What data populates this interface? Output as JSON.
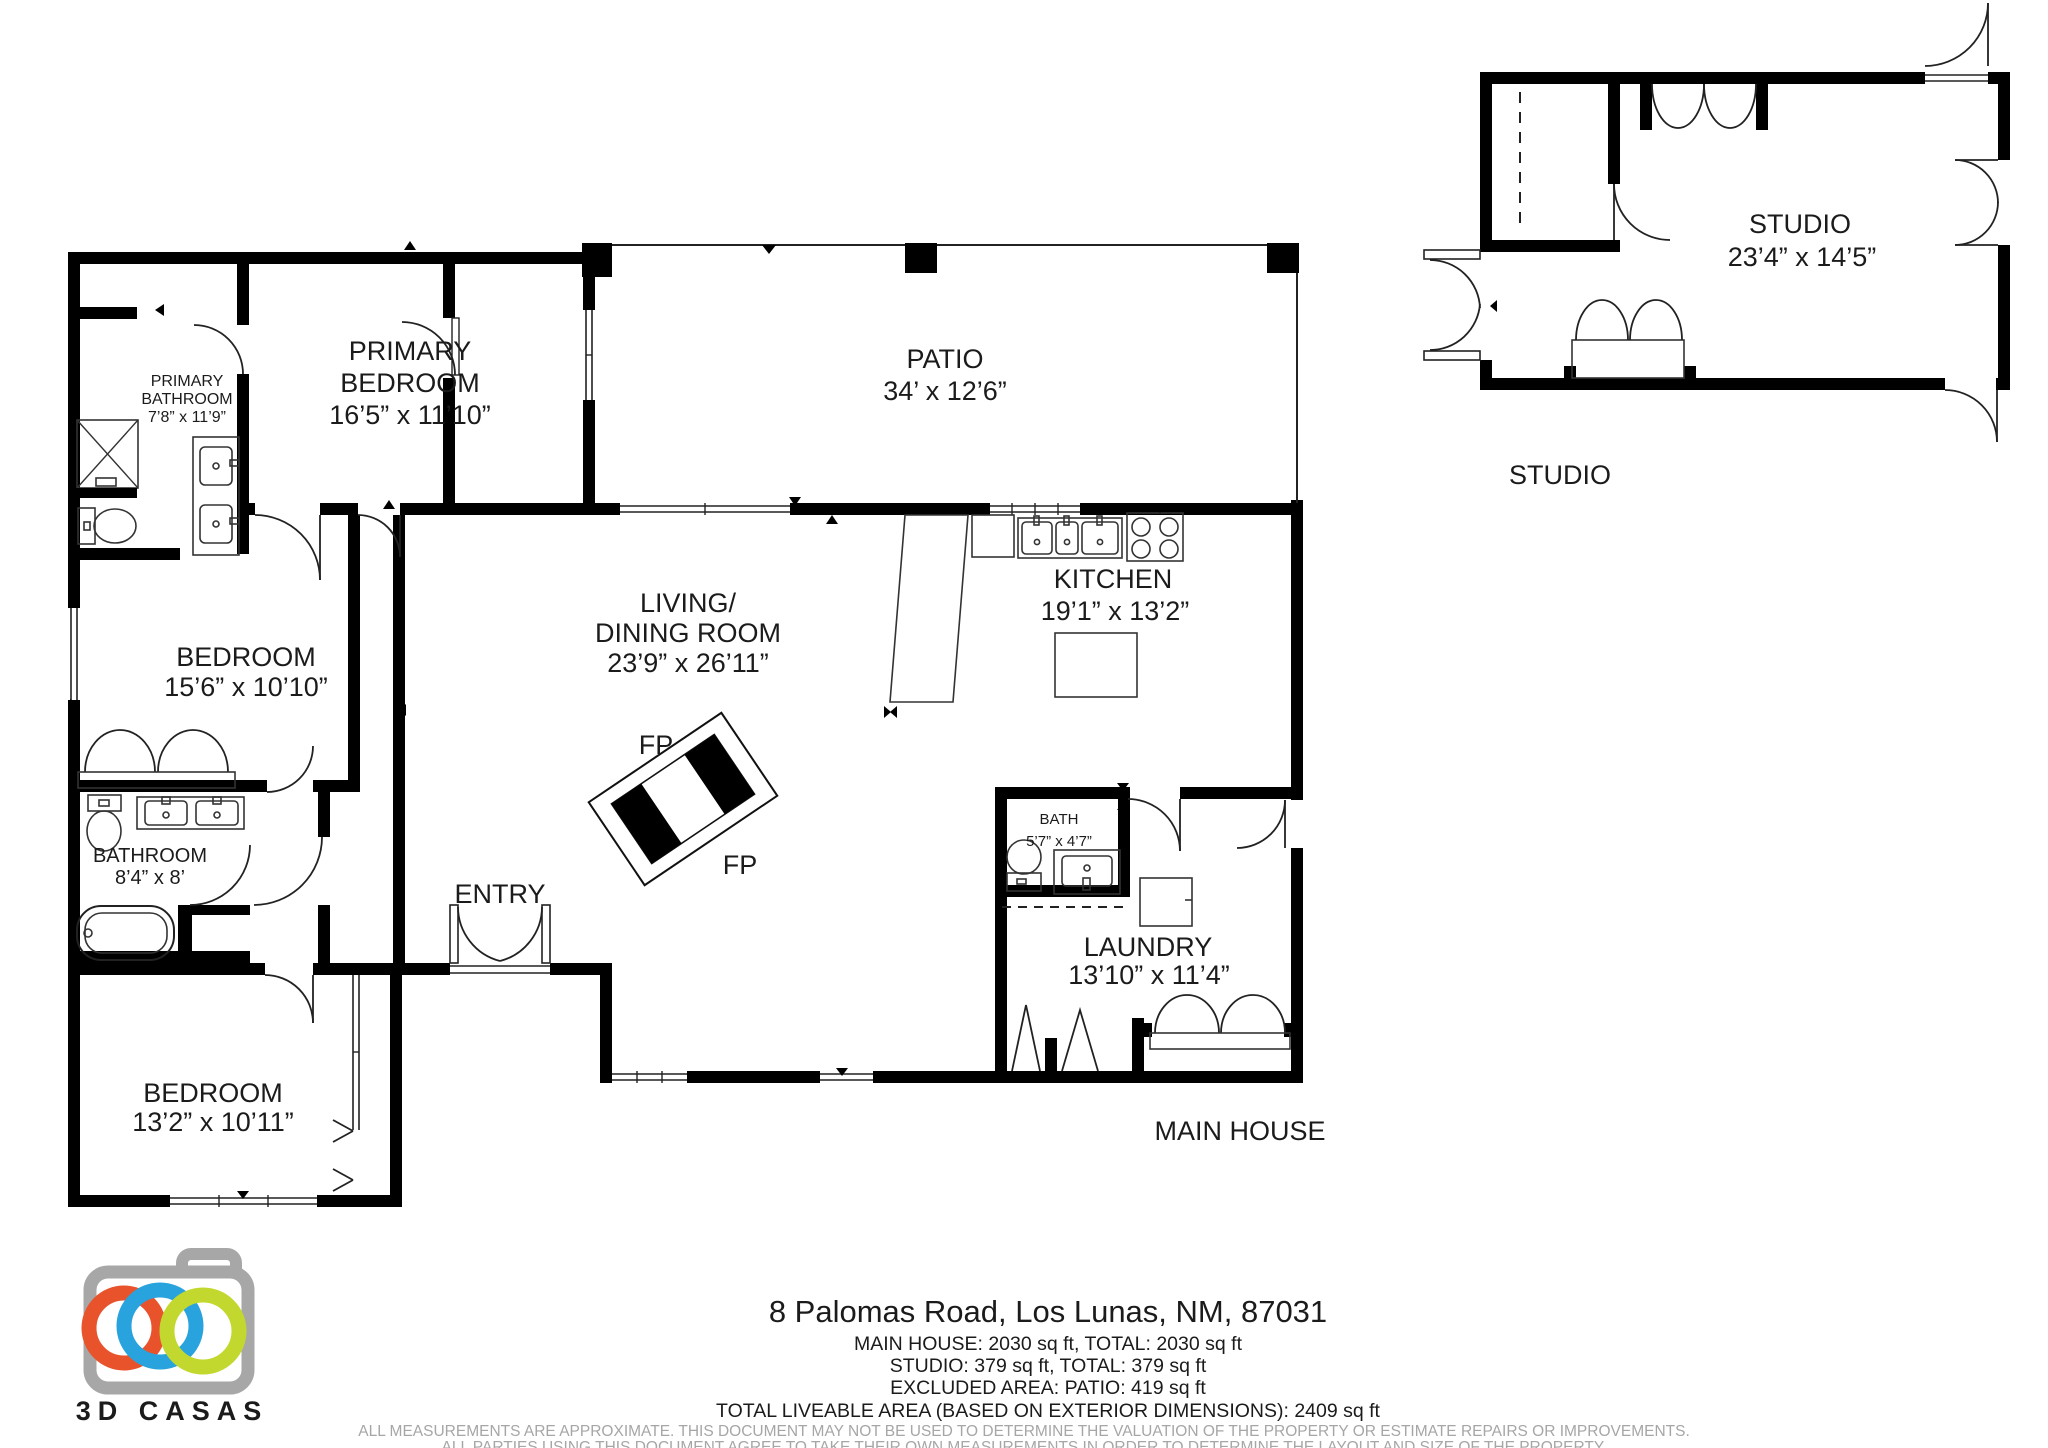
{
  "house": {
    "primary_bathroom": {
      "l1": "PRIMARY",
      "l2": "BATHROOM",
      "dims": "7’8” x 11’9”"
    },
    "primary_bedroom": {
      "l1": "PRIMARY",
      "l2": "BEDROOM",
      "dims": "16’5” x 11’10”"
    },
    "patio": {
      "l1": "PATIO",
      "dims": "34’ x 12’6”"
    },
    "living": {
      "l1": "LIVING/",
      "l2": "DINING ROOM",
      "dims": "23’9” x 26’11”"
    },
    "kitchen": {
      "l1": "KITCHEN",
      "dims": "19’1” x 13’2”"
    },
    "bedroom_mid": {
      "l1": "BEDROOM",
      "dims": "15’6” x 10’10”"
    },
    "bathroom": {
      "l1": "BATHROOM",
      "dims": "8’4” x 8’"
    },
    "bath": {
      "l1": "BATH",
      "dims": "5’7” x 4’7”"
    },
    "laundry": {
      "l1": "LAUNDRY",
      "dims": "13’10” x 11’4”"
    },
    "bedroom_bottom": {
      "l1": "BEDROOM",
      "dims": "13’2” x 10’11”"
    },
    "entry": "ENTRY",
    "fp": "FP",
    "caption": "MAIN HOUSE"
  },
  "studio": {
    "l1": "STUDIO",
    "dims": "23’4” x 14’5”",
    "caption": "STUDIO"
  },
  "footer": {
    "address": "8 Palomas Road, Los Lunas, NM, 87031",
    "line1": "MAIN HOUSE: 2030 sq ft, TOTAL: 2030 sq ft",
    "line2": "STUDIO: 379 sq ft, TOTAL: 379 sq ft",
    "line3": "EXCLUDED AREA: PATIO: 419 sq ft",
    "line4": "TOTAL LIVEABLE AREA (BASED ON EXTERIOR DIMENSIONS): 2409 sq ft",
    "disclaimer1": "ALL MEASUREMENTS ARE APPROXIMATE. THIS DOCUMENT MAY NOT BE USED TO DETERMINE THE VALUATION OF THE PROPERTY OR ESTIMATE REPAIRS OR IMPROVEMENTS.",
    "disclaimer2": "ALL PARTIES USING THIS DOCUMENT AGREE TO TAKE THEIR OWN MEASUREMENTS IN ORDER TO DETERMINE THE LAYOUT AND SIZE OF THE PROPERTY."
  },
  "logo": {
    "brand": "3D CASAS",
    "colors": {
      "body": "#a7a7a7",
      "ring_orange": "#e8532c",
      "ring_blue": "#29a3dd",
      "ring_green": "#c3d82e"
    }
  }
}
